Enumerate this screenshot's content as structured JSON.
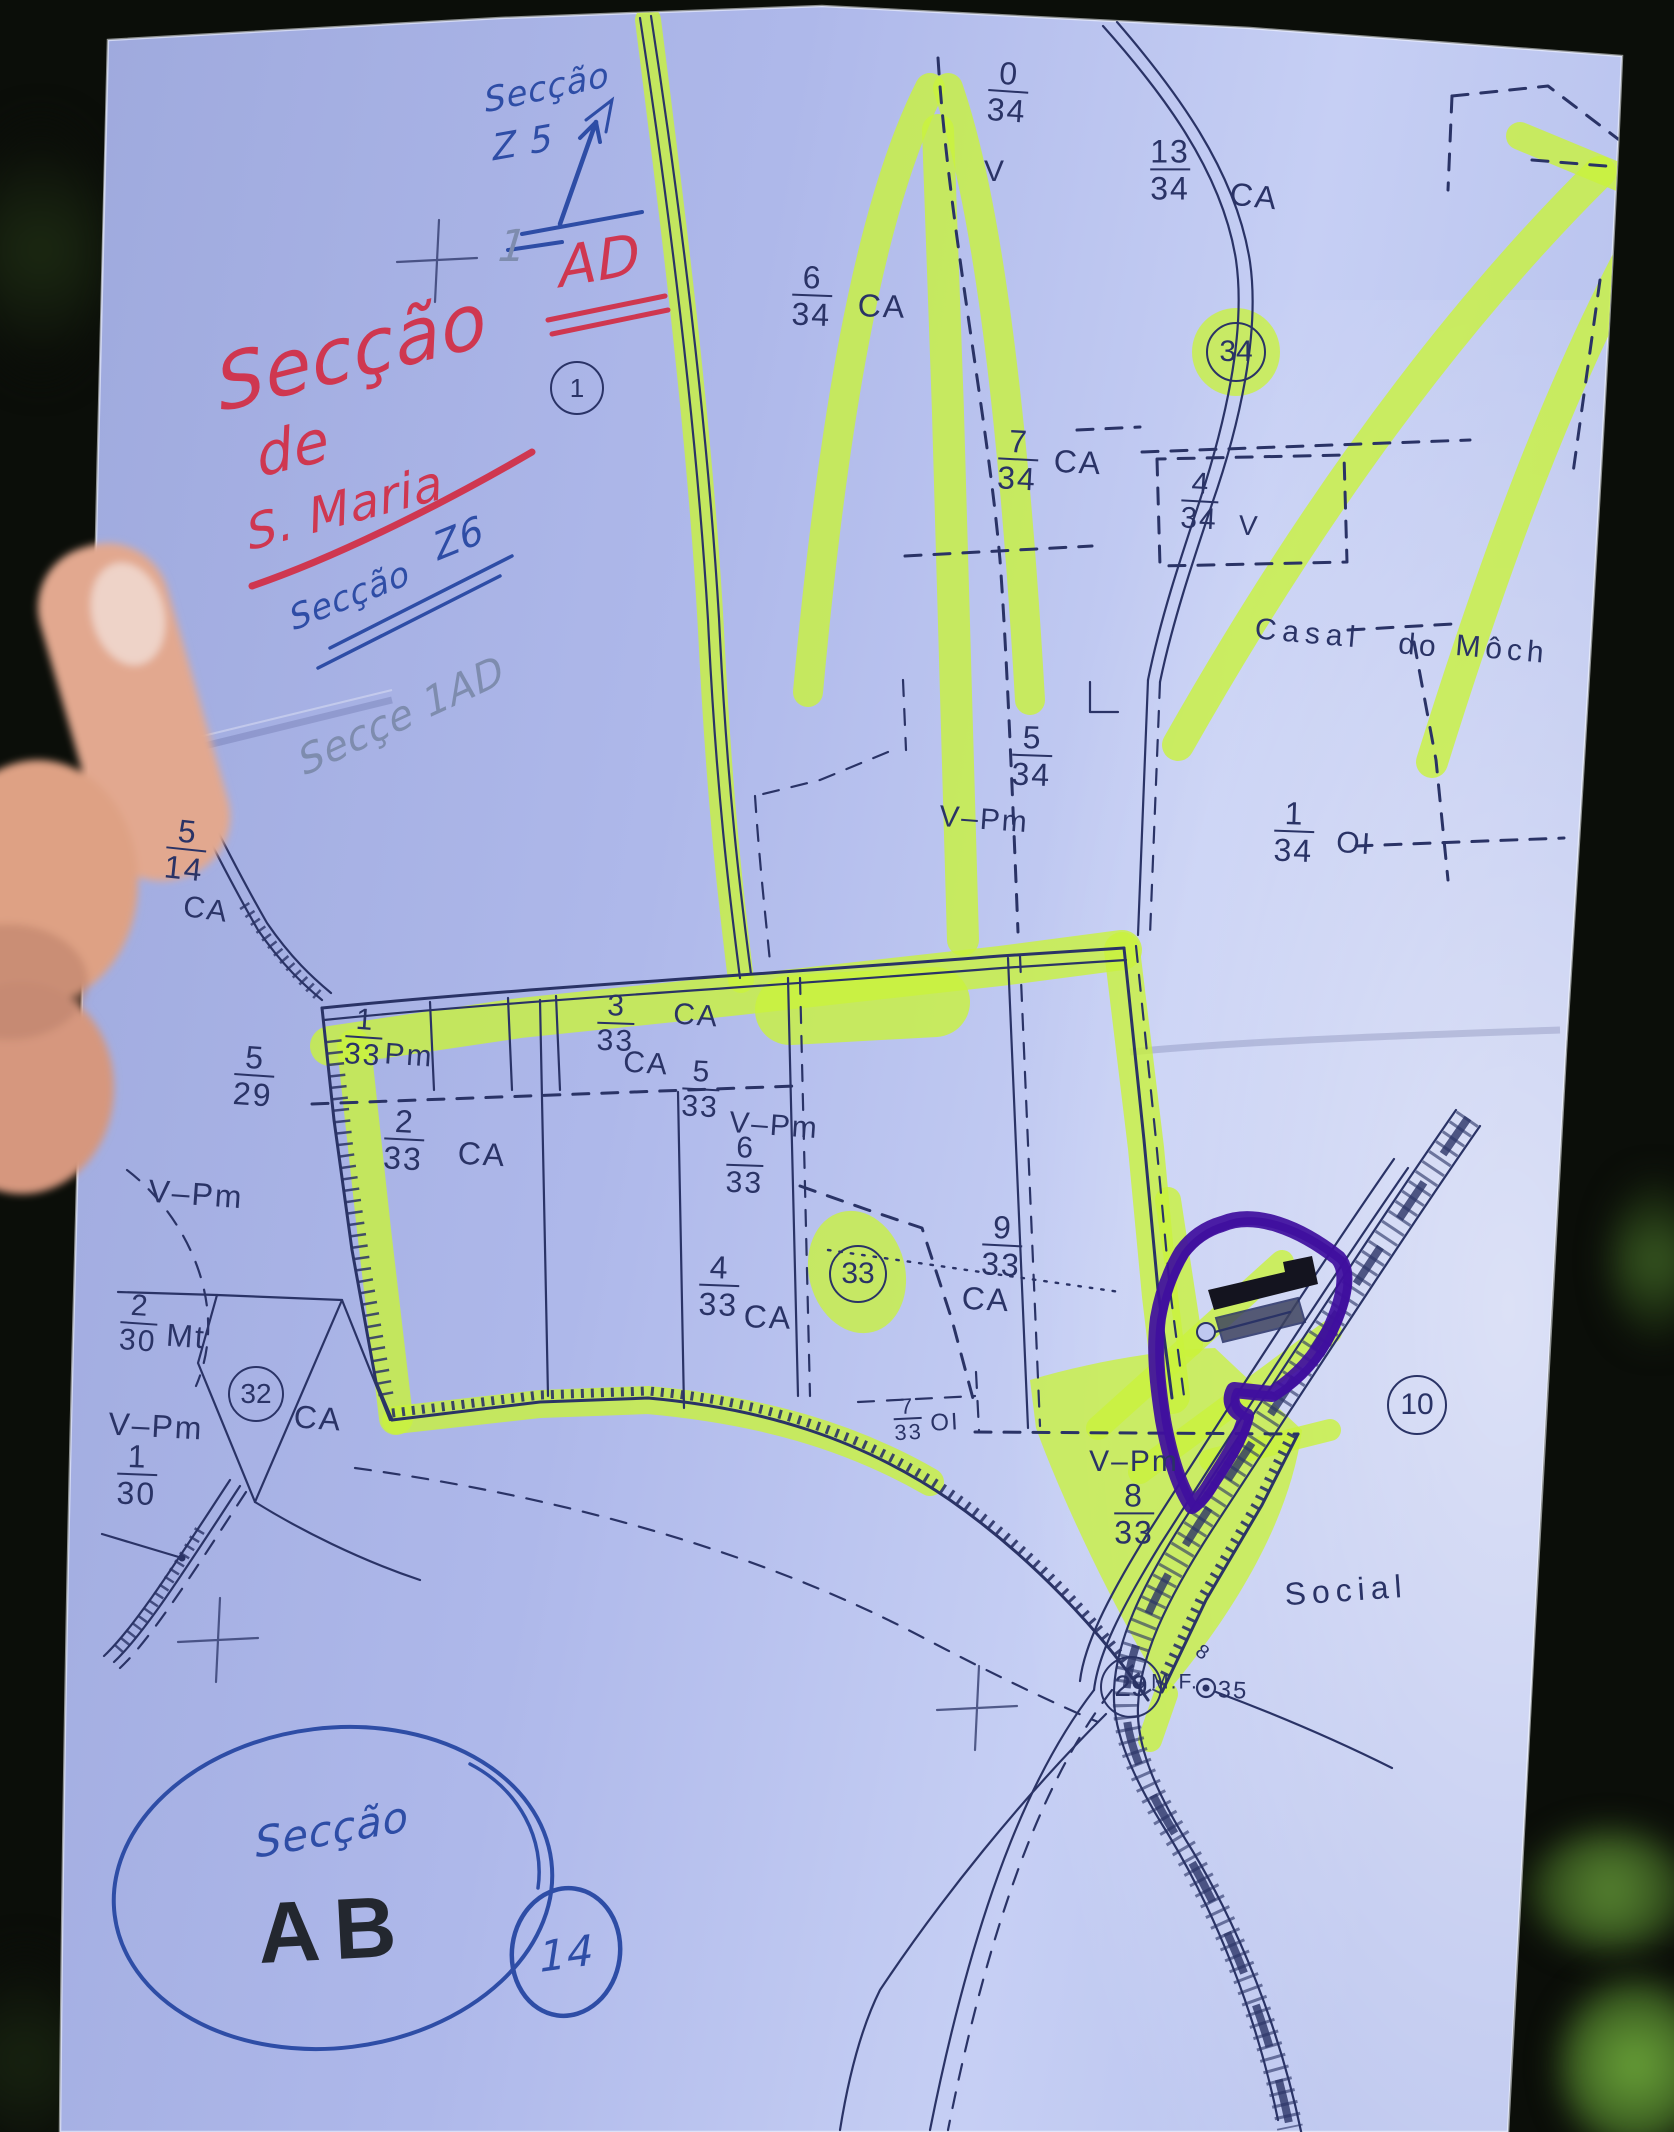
{
  "scene": {
    "description": "photo of cadastral map sheet held in hand",
    "palette": {
      "background": "#0b0e09",
      "paper": "#aeb8ea",
      "paper_bright": "#ccd4f6",
      "ink": "#2a3366",
      "hl": "#c9f23c",
      "purple": "#3f0f9e",
      "red": "#cf3750",
      "blue": "#2e4da6",
      "pencil": "#7e8cae",
      "dark": "#23272f",
      "skin": "#e2a88f",
      "nail": "#eed3c8"
    }
  },
  "labels": [
    {
      "name": "parcel-0-34",
      "kind": "fraction",
      "num": "0",
      "den": "34",
      "x": 1008,
      "y": 92,
      "size": 32,
      "rot": 4
    },
    {
      "name": "v-0-34",
      "kind": "text",
      "text": "V",
      "x": 995,
      "y": 172,
      "size": 30,
      "rot": 0
    },
    {
      "name": "parcel-13-34",
      "kind": "fraction",
      "num": "13",
      "den": "34",
      "x": 1170,
      "y": 170,
      "size": 32,
      "rot": 0
    },
    {
      "name": "ca-13-34",
      "kind": "text",
      "text": "CA",
      "x": 1254,
      "y": 196,
      "size": 32,
      "rot": 6
    },
    {
      "name": "parcel-6-34",
      "kind": "fraction",
      "num": "6",
      "den": "34",
      "x": 812,
      "y": 296,
      "size": 32,
      "rot": 2
    },
    {
      "name": "ca-6-34",
      "kind": "text",
      "text": "CA",
      "x": 882,
      "y": 306,
      "size": 32,
      "rot": 2
    },
    {
      "name": "parcel-7-34",
      "kind": "fraction",
      "num": "7",
      "den": "34",
      "x": 1018,
      "y": 460,
      "size": 32,
      "rot": 3
    },
    {
      "name": "ca-7-34",
      "kind": "text",
      "text": "CA",
      "x": 1078,
      "y": 462,
      "size": 32,
      "rot": 3
    },
    {
      "name": "circled-34",
      "kind": "circled",
      "text": "34",
      "x": 1236,
      "y": 352,
      "size": 30,
      "rot": 0,
      "d": 56
    },
    {
      "name": "parcel-4-34",
      "kind": "fraction",
      "num": "4",
      "den": "34",
      "x": 1200,
      "y": 502,
      "size": 30,
      "rot": 3
    },
    {
      "name": "v-4-34",
      "kind": "text",
      "text": "V",
      "x": 1249,
      "y": 526,
      "size": 28,
      "rot": 3
    },
    {
      "name": "casal",
      "kind": "text",
      "text": "Casal",
      "x": 1308,
      "y": 634,
      "size": 30,
      "rot": 5,
      "ls": 6
    },
    {
      "name": "do",
      "kind": "text",
      "text": "do",
      "x": 1419,
      "y": 646,
      "size": 30,
      "rot": 5,
      "ls": 4
    },
    {
      "name": "mocho",
      "kind": "text",
      "text": "Môch",
      "x": 1502,
      "y": 650,
      "size": 30,
      "rot": 5,
      "ls": 5
    },
    {
      "name": "parcel-5-34",
      "kind": "fraction",
      "num": "5",
      "den": "34",
      "x": 1032,
      "y": 756,
      "size": 32,
      "rot": 2
    },
    {
      "name": "vpm-5-34",
      "kind": "text",
      "text": "V–Pm",
      "x": 984,
      "y": 820,
      "size": 30,
      "rot": 4
    },
    {
      "name": "parcel-1-34",
      "kind": "fraction",
      "num": "1",
      "den": "34",
      "x": 1294,
      "y": 832,
      "size": 32,
      "rot": 2
    },
    {
      "name": "oi-1-34",
      "kind": "text",
      "text": "OI",
      "x": 1354,
      "y": 844,
      "size": 30,
      "rot": 4
    },
    {
      "name": "parcel-5-14",
      "kind": "fraction",
      "num": "5",
      "den": "14",
      "x": 186,
      "y": 850,
      "size": 32,
      "rot": 6
    },
    {
      "name": "ca-5-14",
      "kind": "text",
      "text": "CA",
      "x": 206,
      "y": 910,
      "size": 30,
      "rot": 8
    },
    {
      "name": "parcel-5-29",
      "kind": "fraction",
      "num": "5",
      "den": "29",
      "x": 254,
      "y": 1076,
      "size": 32,
      "rot": 4
    },
    {
      "name": "parcel-1-33",
      "kind": "fraction",
      "num": "1",
      "den": "33",
      "x": 364,
      "y": 1038,
      "size": 30,
      "rot": 4
    },
    {
      "name": "pm-1-33",
      "kind": "text",
      "text": "Pm",
      "x": 409,
      "y": 1056,
      "size": 30,
      "rot": 4
    },
    {
      "name": "parcel-2-33",
      "kind": "fraction",
      "num": "2",
      "den": "33",
      "x": 404,
      "y": 1140,
      "size": 32,
      "rot": 3
    },
    {
      "name": "ca-2-33",
      "kind": "text",
      "text": "CA",
      "x": 482,
      "y": 1154,
      "size": 32,
      "rot": 3
    },
    {
      "name": "parcel-3-33",
      "kind": "fraction",
      "num": "3",
      "den": "33",
      "x": 616,
      "y": 1024,
      "size": 30,
      "rot": 2
    },
    {
      "name": "ca-33-a",
      "kind": "text",
      "text": "CA",
      "x": 696,
      "y": 1016,
      "size": 30,
      "rot": 4
    },
    {
      "name": "ca-33-b",
      "kind": "text",
      "text": "CA",
      "x": 646,
      "y": 1064,
      "size": 30,
      "rot": 4
    },
    {
      "name": "parcel-5-33",
      "kind": "fraction",
      "num": "5",
      "den": "33",
      "x": 701,
      "y": 1090,
      "size": 30,
      "rot": 3
    },
    {
      "name": "vpm-33",
      "kind": "text",
      "text": "V–Pm",
      "x": 774,
      "y": 1126,
      "size": 30,
      "rot": 4
    },
    {
      "name": "parcel-6-33",
      "kind": "fraction",
      "num": "6",
      "den": "33",
      "x": 745,
      "y": 1166,
      "size": 30,
      "rot": 2
    },
    {
      "name": "parcel-9-33",
      "kind": "fraction",
      "num": "9",
      "den": "33",
      "x": 1002,
      "y": 1246,
      "size": 32,
      "rot": 3
    },
    {
      "name": "ca-9-33",
      "kind": "text",
      "text": "CA",
      "x": 986,
      "y": 1299,
      "size": 32,
      "rot": 3
    },
    {
      "name": "circled-33",
      "kind": "circled",
      "text": "33",
      "x": 858,
      "y": 1274,
      "size": 30,
      "rot": 0,
      "d": 54
    },
    {
      "name": "parcel-4-33",
      "kind": "fraction",
      "num": "4",
      "den": "33",
      "x": 719,
      "y": 1286,
      "size": 32,
      "rot": 2
    },
    {
      "name": "ca-4-33",
      "kind": "text",
      "text": "CA",
      "x": 768,
      "y": 1317,
      "size": 32,
      "rot": 2
    },
    {
      "name": "vpm-nw",
      "kind": "text",
      "text": "V–Pm",
      "x": 196,
      "y": 1194,
      "size": 32,
      "rot": 4
    },
    {
      "name": "parcel-2-30",
      "kind": "fraction",
      "num": "2",
      "den": "30",
      "x": 139,
      "y": 1324,
      "size": 30,
      "rot": 4
    },
    {
      "name": "mt-2-30",
      "kind": "text",
      "text": "Mt",
      "x": 186,
      "y": 1336,
      "size": 32,
      "rot": 4
    },
    {
      "name": "circled-32",
      "kind": "circled",
      "text": "32",
      "x": 256,
      "y": 1394,
      "size": 28,
      "rot": 0,
      "d": 52
    },
    {
      "name": "ca-32",
      "kind": "text",
      "text": "CA",
      "x": 318,
      "y": 1418,
      "size": 32,
      "rot": 4
    },
    {
      "name": "vpm-sw",
      "kind": "text",
      "text": "V–Pm",
      "x": 156,
      "y": 1426,
      "size": 32,
      "rot": 3
    },
    {
      "name": "parcel-1-30",
      "kind": "fraction",
      "num": "1",
      "den": "30",
      "x": 137,
      "y": 1475,
      "size": 32,
      "rot": 2
    },
    {
      "name": "parcel-7-33",
      "kind": "fraction",
      "num": "7",
      "den": "33",
      "x": 908,
      "y": 1420,
      "size": 22,
      "rot": -3
    },
    {
      "name": "oi-7-33",
      "kind": "text",
      "text": "OI",
      "x": 945,
      "y": 1423,
      "size": 24,
      "rot": -3
    },
    {
      "name": "vpm-8-33",
      "kind": "text",
      "text": "V–Pm",
      "x": 1134,
      "y": 1462,
      "size": 30,
      "rot": 0
    },
    {
      "name": "parcel-8-33",
      "kind": "fraction",
      "num": "8",
      "den": "33",
      "x": 1134,
      "y": 1514,
      "size": 32,
      "rot": 0
    },
    {
      "name": "circled-10",
      "kind": "circled",
      "text": "10",
      "x": 1417,
      "y": 1405,
      "size": 30,
      "rot": 0,
      "d": 56
    },
    {
      "name": "social",
      "kind": "text",
      "text": "Social",
      "x": 1346,
      "y": 1590,
      "size": 32,
      "rot": -4,
      "ls": 6
    },
    {
      "name": "circled-29",
      "kind": "circled",
      "text": "29",
      "x": 1131,
      "y": 1687,
      "size": 30,
      "rot": 0,
      "d": 58
    },
    {
      "name": "mf",
      "kind": "text",
      "text": "M.F.",
      "x": 1175,
      "y": 1682,
      "size": 21,
      "rot": 0
    },
    {
      "name": "benchmark-35",
      "kind": "text",
      "text": "35",
      "x": 1233,
      "y": 1691,
      "size": 24,
      "rot": 3
    },
    {
      "name": "rail-8",
      "kind": "text",
      "text": "8",
      "x": 1203,
      "y": 1653,
      "size": 20,
      "rot": 35
    },
    {
      "name": "circled-1",
      "kind": "circled",
      "text": "1",
      "x": 577,
      "y": 388,
      "size": 26,
      "rot": 0,
      "d": 50
    },
    {
      "name": "print-ab",
      "kind": "text",
      "text": "AB",
      "x": 334,
      "y": 1930,
      "size": 86,
      "rot": -3,
      "ls": 14,
      "color": "dark",
      "weight": 700
    },
    {
      "name": "hw-seccao-z5",
      "kind": "text",
      "text": "Secção",
      "x": 547,
      "y": 88,
      "size": 34,
      "rot": -12,
      "color": "blue",
      "hand": true
    },
    {
      "name": "hw-z5",
      "kind": "text",
      "text": "Z 5",
      "x": 523,
      "y": 144,
      "size": 36,
      "rot": -10,
      "color": "blue",
      "hand": true
    },
    {
      "name": "hw-seccao-red",
      "kind": "text",
      "text": "Secção",
      "x": 352,
      "y": 352,
      "size": 76,
      "rot": -14,
      "color": "red",
      "hand": true
    },
    {
      "name": "hw-ad",
      "kind": "text",
      "text": "AD",
      "x": 600,
      "y": 262,
      "size": 56,
      "rot": -10,
      "color": "red",
      "hand": true
    },
    {
      "name": "hw-1-pencil",
      "kind": "text",
      "text": "1",
      "x": 513,
      "y": 247,
      "size": 44,
      "rot": 0,
      "color": "pencil",
      "hand": true
    },
    {
      "name": "hw-de",
      "kind": "text",
      "text": "de",
      "x": 293,
      "y": 448,
      "size": 58,
      "rot": -14,
      "color": "red",
      "hand": true
    },
    {
      "name": "hw-s-maria",
      "kind": "text",
      "text": "S. Maria",
      "x": 345,
      "y": 508,
      "size": 48,
      "rot": -15,
      "color": "red",
      "hand": true
    },
    {
      "name": "hw-seccao-z6",
      "kind": "text",
      "text": "Secção",
      "x": 350,
      "y": 596,
      "size": 34,
      "rot": -22,
      "color": "blue",
      "hand": true
    },
    {
      "name": "hw-z6",
      "kind": "text",
      "text": "Z6",
      "x": 459,
      "y": 538,
      "size": 38,
      "rot": -22,
      "color": "blue",
      "hand": true
    },
    {
      "name": "hw-secce-1ad",
      "kind": "text",
      "text": "Secçe 1AD",
      "x": 402,
      "y": 716,
      "size": 40,
      "rot": -25,
      "color": "pencil",
      "hand": true
    },
    {
      "name": "hw-seccao-ab",
      "kind": "text",
      "text": "Secção",
      "x": 332,
      "y": 1830,
      "size": 42,
      "rot": -10,
      "color": "blue",
      "hand": true
    },
    {
      "name": "hw-14",
      "kind": "text",
      "text": "14",
      "x": 567,
      "y": 1954,
      "size": 42,
      "rot": -8,
      "color": "blue",
      "hand": true
    }
  ]
}
